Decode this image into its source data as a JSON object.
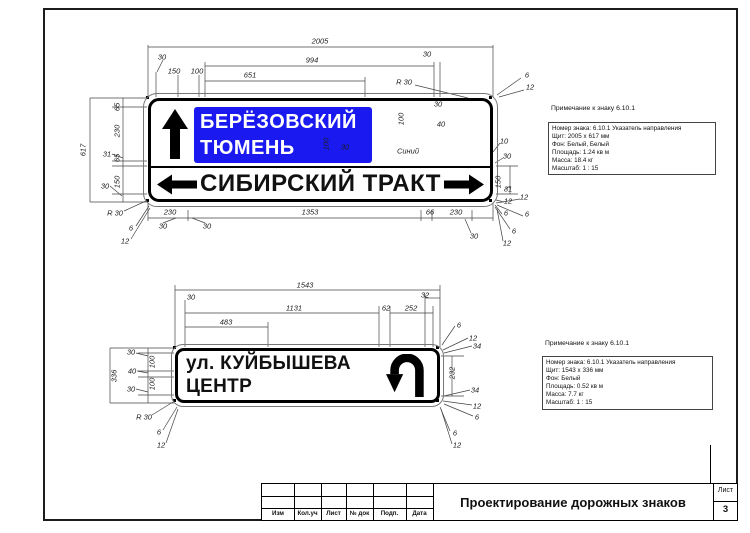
{
  "drawing": {
    "top_sign": {
      "panel_line1": "БЕРЁЗОВСКИЙ",
      "panel_line2": "ТЮМЕНЬ",
      "panel_color": "#1a1af0",
      "bottom_row_text": "СИБИРСКИЙ ТРАКТ",
      "icons": [
        "up-arrow",
        "left-arrow",
        "right-arrow"
      ],
      "note": {
        "heading": "Примечание к знаку 6.10.1",
        "lines": [
          "Номер знака: 6.10.1 Указатель направления",
          "Щит: 2005 x 617 мм",
          "Фон: Белый, Белый",
          "Площадь: 1.24 кв м",
          "Масса: 18.4 кг",
          "Масштаб: 1 : 15"
        ]
      },
      "dims": [
        {
          "t": "2005",
          "x": 320,
          "y": 41,
          "r": 0
        },
        {
          "t": "30",
          "x": 162,
          "y": 57,
          "r": 0
        },
        {
          "t": "994",
          "x": 312,
          "y": 60,
          "r": 0
        },
        {
          "t": "30",
          "x": 427,
          "y": 54,
          "r": 0
        },
        {
          "t": "150",
          "x": 174,
          "y": 71,
          "r": 0
        },
        {
          "t": "100",
          "x": 197,
          "y": 71,
          "r": 0
        },
        {
          "t": "651",
          "x": 250,
          "y": 75,
          "r": 0
        },
        {
          "t": "R 30",
          "x": 404,
          "y": 82,
          "r": 0
        },
        {
          "t": "6",
          "x": 527,
          "y": 75,
          "r": 0
        },
        {
          "t": "12",
          "x": 530,
          "y": 87,
          "r": 0
        },
        {
          "t": "30",
          "x": 438,
          "y": 104,
          "r": 0
        },
        {
          "t": "100",
          "x": 401,
          "y": 119,
          "r": -90
        },
        {
          "t": "40",
          "x": 441,
          "y": 124,
          "r": 0
        },
        {
          "t": "100",
          "x": 326,
          "y": 144,
          "r": -90
        },
        {
          "t": "30",
          "x": 345,
          "y": 147,
          "r": 0
        },
        {
          "t": "Синий",
          "x": 408,
          "y": 151,
          "r": 0
        },
        {
          "t": "617",
          "x": 83,
          "y": 150,
          "r": -90
        },
        {
          "t": "65",
          "x": 117,
          "y": 107,
          "r": -90
        },
        {
          "t": "230",
          "x": 117,
          "y": 131,
          "r": -90
        },
        {
          "t": "31",
          "x": 107,
          "y": 154,
          "r": 0
        },
        {
          "t": "65",
          "x": 117,
          "y": 158,
          "r": -90
        },
        {
          "t": "150",
          "x": 117,
          "y": 182,
          "r": -90
        },
        {
          "t": "30",
          "x": 105,
          "y": 186,
          "r": 0
        },
        {
          "t": "R 30",
          "x": 115,
          "y": 213,
          "r": 0
        },
        {
          "t": "6",
          "x": 131,
          "y": 228,
          "r": 0
        },
        {
          "t": "12",
          "x": 125,
          "y": 241,
          "r": 0
        },
        {
          "t": "230",
          "x": 170,
          "y": 212,
          "r": 0
        },
        {
          "t": "30",
          "x": 163,
          "y": 226,
          "r": 0
        },
        {
          "t": "30",
          "x": 207,
          "y": 226,
          "r": 0
        },
        {
          "t": "1353",
          "x": 310,
          "y": 212,
          "r": 0
        },
        {
          "t": "66",
          "x": 430,
          "y": 212,
          "r": 0
        },
        {
          "t": "230",
          "x": 456,
          "y": 212,
          "r": 0
        },
        {
          "t": "30",
          "x": 474,
          "y": 236,
          "r": 0
        },
        {
          "t": "6",
          "x": 514,
          "y": 231,
          "r": 0
        },
        {
          "t": "12",
          "x": 507,
          "y": 243,
          "r": 0
        },
        {
          "t": "12",
          "x": 524,
          "y": 197,
          "r": 0
        },
        {
          "t": "6",
          "x": 527,
          "y": 214,
          "r": 0
        },
        {
          "t": "10",
          "x": 504,
          "y": 141,
          "r": 0
        },
        {
          "t": "30",
          "x": 507,
          "y": 156,
          "r": 0
        },
        {
          "t": "150",
          "x": 498,
          "y": 182,
          "r": -90
        },
        {
          "t": "31",
          "x": 508,
          "y": 189,
          "r": 0
        },
        {
          "t": "12",
          "x": 508,
          "y": 201,
          "r": 0
        },
        {
          "t": "6",
          "x": 506,
          "y": 213,
          "r": 0
        }
      ]
    },
    "bottom_sign": {
      "line1": "ул. КУЙБЫШЕВА",
      "line2": "ЦЕНТР",
      "icons": [
        "u-turn-arrow"
      ],
      "note": {
        "heading": "Примечание к знаку 6.10.1",
        "lines": [
          "Номер знака: 6.10.1 Указатель направления",
          "Щит: 1543 x 336 мм",
          "Фон: Белый",
          "Площадь: 0.52 кв м",
          "Масса: 7.7 кг",
          "Масштаб: 1 : 15"
        ]
      },
      "dims": [
        {
          "t": "1543",
          "x": 305,
          "y": 285,
          "r": 0
        },
        {
          "t": "30",
          "x": 191,
          "y": 297,
          "r": 0
        },
        {
          "t": "1131",
          "x": 294,
          "y": 308,
          "r": 0
        },
        {
          "t": "32",
          "x": 425,
          "y": 295,
          "r": 0
        },
        {
          "t": "62",
          "x": 386,
          "y": 308,
          "r": 0
        },
        {
          "t": "252",
          "x": 411,
          "y": 308,
          "r": 0
        },
        {
          "t": "483",
          "x": 226,
          "y": 322,
          "r": 0
        },
        {
          "t": "6",
          "x": 459,
          "y": 325,
          "r": 0
        },
        {
          "t": "12",
          "x": 473,
          "y": 338,
          "r": 0
        },
        {
          "t": "34",
          "x": 477,
          "y": 346,
          "r": 0
        },
        {
          "t": "232",
          "x": 452,
          "y": 373,
          "r": -90
        },
        {
          "t": "34",
          "x": 475,
          "y": 390,
          "r": 0
        },
        {
          "t": "12",
          "x": 477,
          "y": 406,
          "r": 0
        },
        {
          "t": "6",
          "x": 477,
          "y": 417,
          "r": 0
        },
        {
          "t": "6",
          "x": 455,
          "y": 433,
          "r": 0
        },
        {
          "t": "12",
          "x": 457,
          "y": 445,
          "r": 0
        },
        {
          "t": "336",
          "x": 114,
          "y": 376,
          "r": -90
        },
        {
          "t": "30",
          "x": 131,
          "y": 352,
          "r": 0
        },
        {
          "t": "100",
          "x": 152,
          "y": 362,
          "r": -90
        },
        {
          "t": "40",
          "x": 132,
          "y": 371,
          "r": 0
        },
        {
          "t": "100",
          "x": 152,
          "y": 384,
          "r": -90
        },
        {
          "t": "30",
          "x": 131,
          "y": 389,
          "r": 0
        },
        {
          "t": "R 30",
          "x": 144,
          "y": 417,
          "r": 0
        },
        {
          "t": "6",
          "x": 159,
          "y": 432,
          "r": 0
        },
        {
          "t": "12",
          "x": 161,
          "y": 445,
          "r": 0
        }
      ]
    }
  },
  "title_block": {
    "columns": [
      "Изм",
      "Кол.уч",
      "Лист",
      "№ док",
      "Подп.",
      "Дата"
    ],
    "title": "Проектирование дорожных знаков",
    "sheet_label": "Лист",
    "sheet_number": "3"
  }
}
